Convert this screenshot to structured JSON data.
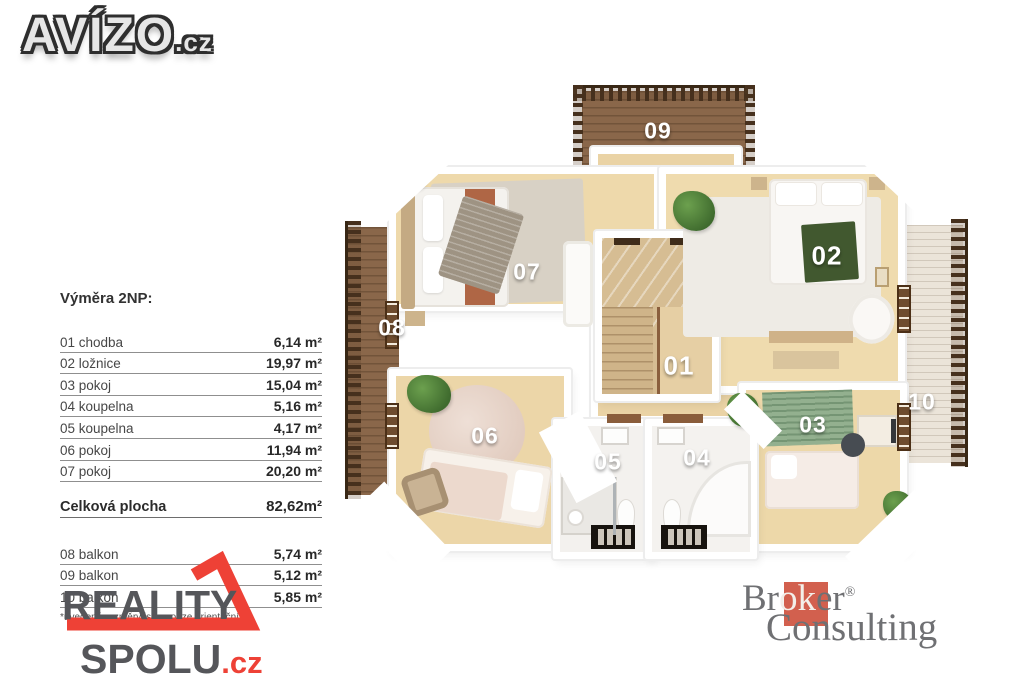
{
  "branding": {
    "avizo": {
      "text": "AVÍZO",
      "tld": ".cz"
    },
    "reality_spolu": {
      "line1": "REALITY",
      "line2": "SPOLU",
      "tld": ".cz",
      "red": "#ee4136",
      "gray": "#55565a"
    },
    "broker": {
      "pre": "Br",
      "mid": "ok",
      "post": "er",
      "reg": "®",
      "line2": "Consulting",
      "square_color": "#d2604e",
      "text_color": "#6f7073"
    }
  },
  "legend": {
    "title": "Výměra 2NP:",
    "rows": [
      {
        "label": "01 chodba",
        "value": "6,14 m²"
      },
      {
        "label": "02 ložnice",
        "value": "19,97 m²"
      },
      {
        "label": "03 pokoj",
        "value": "15,04 m²"
      },
      {
        "label": "04 koupelna",
        "value": "5,16 m²"
      },
      {
        "label": "05 koupelna",
        "value": "4,17 m²"
      },
      {
        "label": "06 pokoj",
        "value": "11,94 m²"
      },
      {
        "label": "07 pokoj",
        "value": "20,20 m²"
      }
    ],
    "total": {
      "label": "Celková plocha",
      "value": "82,62m²"
    },
    "balconies": [
      {
        "label": "08 balkon",
        "value": "5,74 m²"
      },
      {
        "label": "09 balkon",
        "value": "5,12 m²"
      },
      {
        "label": "10 balkon",
        "value": "5,85 m²"
      }
    ],
    "note": "*uvedené rozměry jsou pouze orientační"
  },
  "plan": {
    "labels": [
      {
        "num": "01",
        "room": "chodba"
      },
      {
        "num": "02",
        "room": "ložnice"
      },
      {
        "num": "03",
        "room": "pokoj"
      },
      {
        "num": "04",
        "room": "koupelna"
      },
      {
        "num": "05",
        "room": "koupelna"
      },
      {
        "num": "06",
        "room": "pokoj"
      },
      {
        "num": "07",
        "room": "pokoj"
      },
      {
        "num": "08",
        "room": "balkon"
      },
      {
        "num": "09",
        "room": "balkon"
      },
      {
        "num": "10",
        "room": "balkon"
      }
    ]
  }
}
